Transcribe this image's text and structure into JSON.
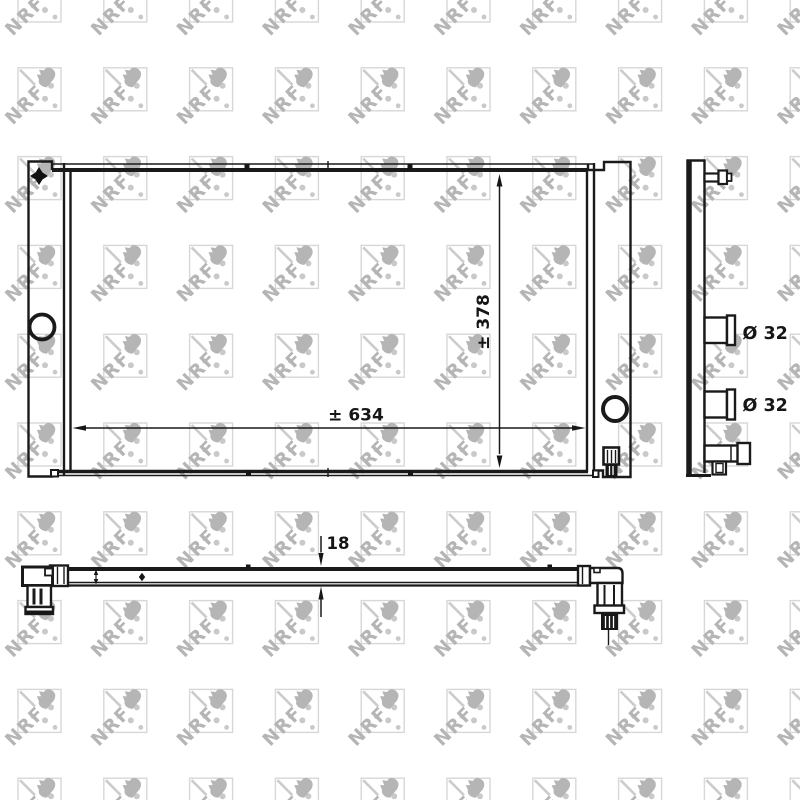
{
  "drawing": {
    "watermark": {
      "text": "NRF"
    },
    "dimensions": {
      "width": "± 634",
      "height": "± 378",
      "thickness": "18",
      "ports": [
        "Ø 32",
        "Ø 32"
      ]
    },
    "colors": {
      "line": "#1a1a1a",
      "fill_dark": "#161616",
      "watermark_logo": "#b5b5b5",
      "watermark_frame": "#d7d7d7",
      "watermark_dots": "#c9c9c9",
      "background": "#ffffff"
    }
  }
}
